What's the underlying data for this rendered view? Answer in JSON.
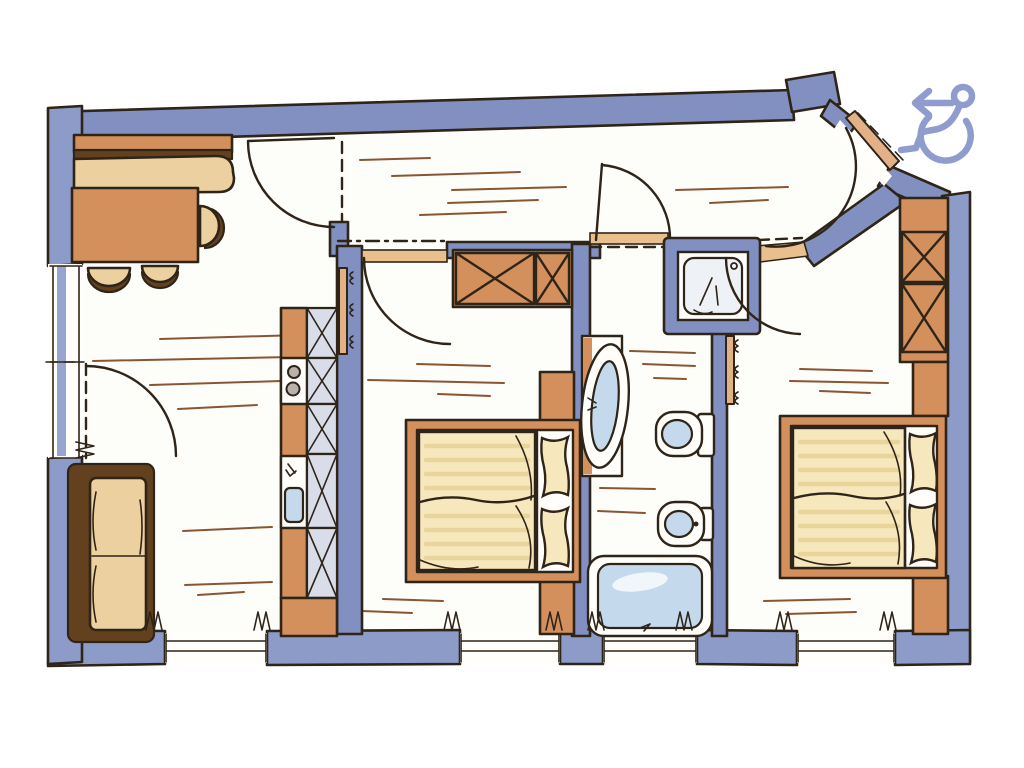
{
  "document": {
    "alt": "Hand-drawn apartment floor plan with periwinkle-blue walls, orange and tan furniture, and a wheelchair accessibility symbol with a left arrow at the top right"
  },
  "colors": {
    "paper": "#ffffff",
    "floor": "#fdfdfa",
    "wall": "#8190c0",
    "wallLight": "#8d9bc9",
    "line": "#2f2418",
    "orange": "#d3905c",
    "orangeSoft": "#e2b185",
    "threshold": "#e9c08d",
    "tan": "#ecd0a0",
    "cream": "#f6e7bc",
    "creamStripe": "#e9d49b",
    "brown": "#63411f",
    "water": "#c4daec",
    "cabinet": "#d8dde9",
    "hatch": "#8a5530",
    "icon": "#8f9ccd"
  },
  "icons": {
    "wheelchair": {
      "label": "wheelchair-accessible",
      "arrowDirection": "left"
    }
  },
  "plan": {
    "rooms": [
      {
        "name": "living-dining-room",
        "items": [
          "corner-bench",
          "dining-table",
          "three-chairs",
          "sofa",
          "window",
          "balcony-door"
        ]
      },
      {
        "name": "kitchen",
        "items": [
          "counter",
          "stove",
          "sink",
          "base-cabinets"
        ]
      },
      {
        "name": "hall",
        "items": [
          "entrance-door"
        ]
      },
      {
        "name": "bedroom-1",
        "items": [
          "wardrobe",
          "double-bed",
          "nightstands",
          "window",
          "radiators"
        ]
      },
      {
        "name": "bathroom",
        "items": [
          "shower",
          "washbasin",
          "toilet",
          "bidet",
          "bathtub",
          "window"
        ]
      },
      {
        "name": "bedroom-2",
        "items": [
          "wardrobe",
          "double-bed",
          "nightstands",
          "window",
          "radiators"
        ]
      },
      {
        "name": "entrance",
        "items": [
          "diagonal-entrance-door"
        ]
      }
    ]
  }
}
